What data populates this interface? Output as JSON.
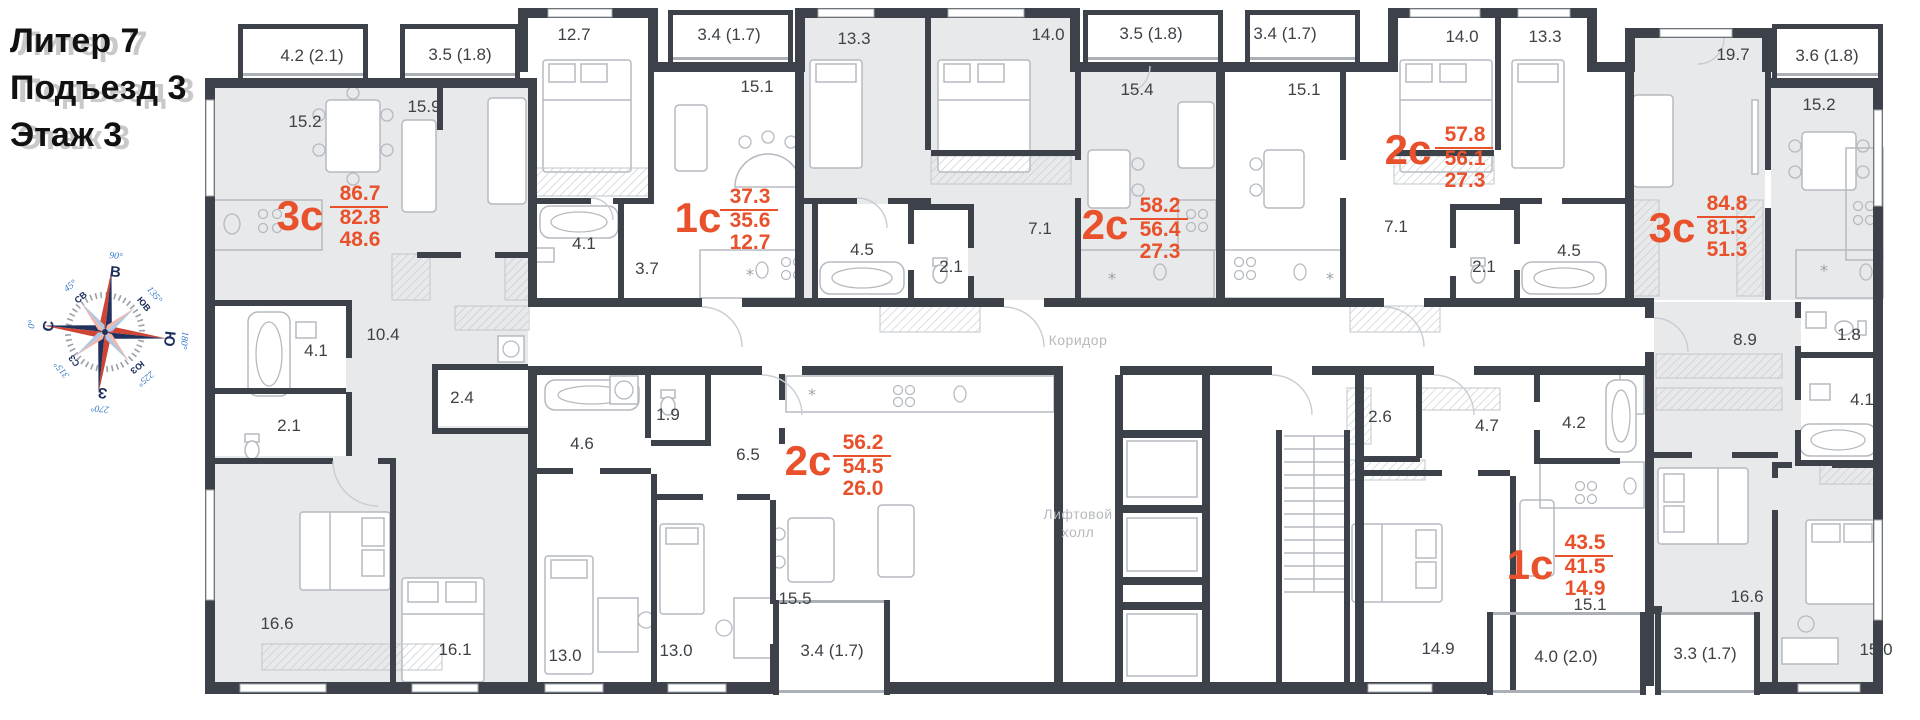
{
  "header": {
    "lines": [
      "Литер 7",
      "Подъезд 3",
      "Этаж 3"
    ]
  },
  "compass": {
    "cardinals": [
      {
        "label": "С",
        "deg": "0°"
      },
      {
        "label": "СВ",
        "deg": "45°"
      },
      {
        "label": "В",
        "deg": "90°"
      },
      {
        "label": "ЮВ",
        "deg": "135°"
      },
      {
        "label": "Ю",
        "deg": "180°"
      },
      {
        "label": "ЮЗ",
        "deg": "225°"
      },
      {
        "label": "З",
        "deg": "270°"
      },
      {
        "label": "СЗ",
        "deg": "315°"
      }
    ]
  },
  "areas": {
    "corridor": "Коридор",
    "lift_hall_line1": "Лифтовой",
    "lift_hall_line2": "холл"
  },
  "apartments": [
    {
      "type": "3с",
      "total": "86.7",
      "living": "82.8",
      "kitchen": "48.6",
      "highlighted": true,
      "tx": 300,
      "ty": 230,
      "vx": 360,
      "vy": 200
    },
    {
      "type": "1с",
      "total": "37.3",
      "living": "35.6",
      "kitchen": "12.7",
      "highlighted": false,
      "tx": 698,
      "ty": 232,
      "vx": 750,
      "vy": 203
    },
    {
      "type": "2с",
      "total": "58.2",
      "living": "56.4",
      "kitchen": "27.3",
      "highlighted": true,
      "tx": 1105,
      "ty": 239,
      "vx": 1160,
      "vy": 212
    },
    {
      "type": "2с",
      "total": "57.8",
      "living": "56.1",
      "kitchen": "27.3",
      "highlighted": false,
      "tx": 1408,
      "ty": 164,
      "vx": 1465,
      "vy": 141
    },
    {
      "type": "3с",
      "total": "84.8",
      "living": "81.3",
      "kitchen": "51.3",
      "highlighted": true,
      "tx": 1672,
      "ty": 242,
      "vx": 1727,
      "vy": 210
    },
    {
      "type": "2с",
      "total": "56.2",
      "living": "54.5",
      "kitchen": "26.0",
      "highlighted": false,
      "tx": 808,
      "ty": 475,
      "vx": 863,
      "vy": 449
    },
    {
      "type": "1с",
      "total": "43.5",
      "living": "41.5",
      "kitchen": "14.9",
      "highlighted": false,
      "tx": 1530,
      "ty": 579,
      "vx": 1585,
      "vy": 549
    }
  ],
  "room_labels": [
    {
      "text": "15.2",
      "x": 305,
      "y": 127
    },
    {
      "text": "15.9",
      "x": 424,
      "y": 112
    },
    {
      "text": "12.7",
      "x": 574,
      "y": 40
    },
    {
      "text": "15.1",
      "x": 757,
      "y": 92
    },
    {
      "text": "4.1",
      "x": 584,
      "y": 249
    },
    {
      "text": "3.7",
      "x": 647,
      "y": 274
    },
    {
      "text": "13.3",
      "x": 854,
      "y": 44
    },
    {
      "text": "14.0",
      "x": 1048,
      "y": 40
    },
    {
      "text": "15.4",
      "x": 1137,
      "y": 95
    },
    {
      "text": "4.5",
      "x": 862,
      "y": 255
    },
    {
      "text": "2.1",
      "x": 951,
      "y": 272
    },
    {
      "text": "7.1",
      "x": 1040,
      "y": 234
    },
    {
      "text": "15.1",
      "x": 1304,
      "y": 95
    },
    {
      "text": "14.0",
      "x": 1462,
      "y": 42
    },
    {
      "text": "13.3",
      "x": 1545,
      "y": 42
    },
    {
      "text": "7.1",
      "x": 1396,
      "y": 232
    },
    {
      "text": "2.1",
      "x": 1484,
      "y": 272
    },
    {
      "text": "4.5",
      "x": 1569,
      "y": 256
    },
    {
      "text": "19.7",
      "x": 1733,
      "y": 60
    },
    {
      "text": "15.2",
      "x": 1819,
      "y": 110
    },
    {
      "text": "10.4",
      "x": 383,
      "y": 340
    },
    {
      "text": "4.1",
      "x": 316,
      "y": 356
    },
    {
      "text": "2.1",
      "x": 289,
      "y": 431
    },
    {
      "text": "2.4",
      "x": 462,
      "y": 403
    },
    {
      "text": "16.6",
      "x": 277,
      "y": 629
    },
    {
      "text": "16.1",
      "x": 455,
      "y": 655
    },
    {
      "text": "4.6",
      "x": 582,
      "y": 449
    },
    {
      "text": "1.9",
      "x": 668,
      "y": 420
    },
    {
      "text": "6.5",
      "x": 748,
      "y": 460
    },
    {
      "text": "13.0",
      "x": 565,
      "y": 661
    },
    {
      "text": "13.0",
      "x": 676,
      "y": 656
    },
    {
      "text": "15.5",
      "x": 795,
      "y": 604
    },
    {
      "text": "8.9",
      "x": 1745,
      "y": 345
    },
    {
      "text": "1.8",
      "x": 1849,
      "y": 340
    },
    {
      "text": "4.1",
      "x": 1862,
      "y": 405
    },
    {
      "text": "16.6",
      "x": 1747,
      "y": 602
    },
    {
      "text": "15.0",
      "x": 1876,
      "y": 655
    },
    {
      "text": "2.6",
      "x": 1380,
      "y": 422
    },
    {
      "text": "4.7",
      "x": 1487,
      "y": 431
    },
    {
      "text": "4.2",
      "x": 1574,
      "y": 428
    },
    {
      "text": "14.9",
      "x": 1438,
      "y": 654
    },
    {
      "text": "15.1",
      "x": 1590,
      "y": 610
    }
  ],
  "balcony_labels": [
    {
      "text": "4.2 (2.1)",
      "x": 312,
      "y": 61
    },
    {
      "text": "3.5 (1.8)",
      "x": 460,
      "y": 60
    },
    {
      "text": "3.4 (1.7)",
      "x": 729,
      "y": 40
    },
    {
      "text": "3.5 (1.8)",
      "x": 1151,
      "y": 39
    },
    {
      "text": "3.4 (1.7)",
      "x": 1285,
      "y": 39
    },
    {
      "text": "3.6 (1.8)",
      "x": 1827,
      "y": 61
    },
    {
      "text": "3.4 (1.7)",
      "x": 832,
      "y": 656
    },
    {
      "text": "4.0 (2.0)",
      "x": 1566,
      "y": 662
    },
    {
      "text": "3.3 (1.7)",
      "x": 1705,
      "y": 659
    }
  ]
}
